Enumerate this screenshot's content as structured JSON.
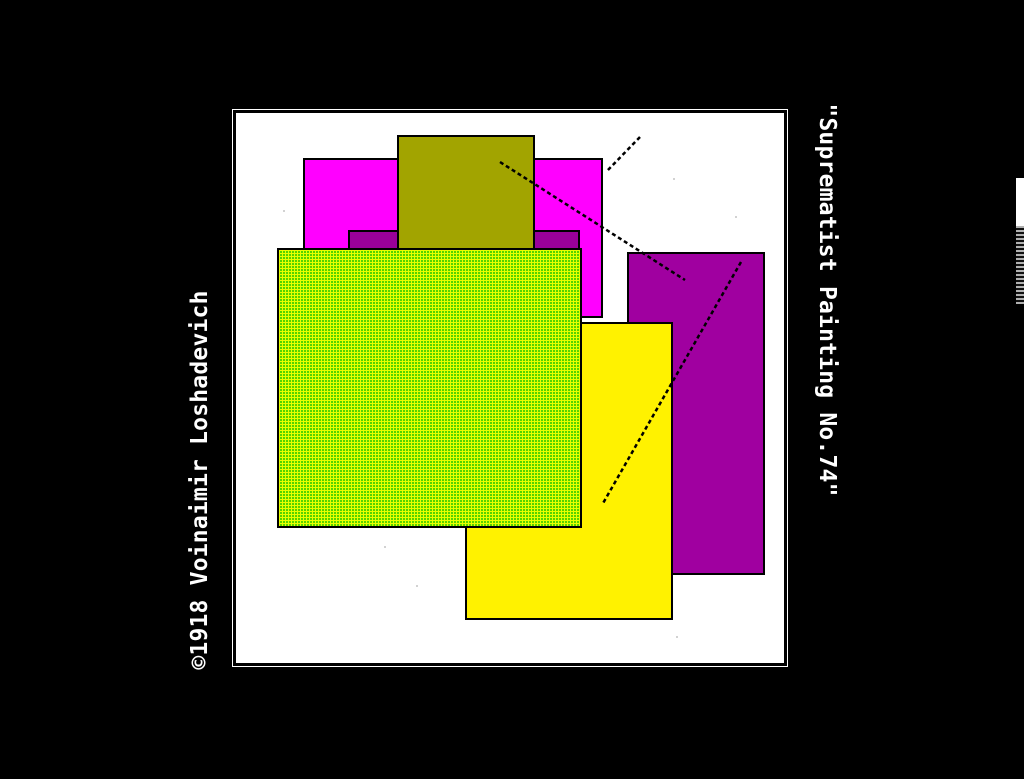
{
  "page": {
    "background": "#000000"
  },
  "artwork": {
    "credit": "©1918 Voinaimir Loshadevich",
    "title": "\"Suprematist Painting No.74\""
  },
  "canvas": {
    "x": 233,
    "y": 110,
    "w": 554,
    "h": 556,
    "color": "#ffffff",
    "border": "#000000"
  },
  "shapes": {
    "magenta": {
      "x": 67,
      "y": 45,
      "w": 300,
      "h": 160,
      "color": "#ff00ff"
    },
    "darkband": {
      "x": 112,
      "y": 117,
      "w": 232,
      "h": 40,
      "color": "#990099"
    },
    "olive": {
      "x": 161,
      "y": 22,
      "w": 138,
      "h": 120,
      "color": "#a2a400"
    },
    "purple": {
      "x": 391,
      "y": 139,
      "w": 138,
      "h": 323,
      "color": "#a000a0"
    },
    "yellow": {
      "x": 229,
      "y": 209,
      "w": 208,
      "h": 298,
      "color": "#fff200"
    },
    "green": {
      "x": 41,
      "y": 135,
      "w": 305,
      "h": 280,
      "color": "#55d400",
      "grid_color": "#e8ff00"
    }
  },
  "lines": {
    "a": {
      "x1": 404,
      "y1": 24,
      "x2": 370,
      "y2": 59
    },
    "b": {
      "x1": 264,
      "y1": 49,
      "x2": 449,
      "y2": 167
    },
    "c": {
      "x1": 505,
      "y1": 149,
      "x2": 366,
      "y2": 392
    }
  },
  "specks": {
    "s1": {
      "x": 47,
      "y": 97,
      "w": 2,
      "h": 2,
      "color": "#c4c4c4"
    },
    "s2": {
      "x": 437,
      "y": 65,
      "w": 2,
      "h": 2,
      "color": "#c4c4c4"
    },
    "s3": {
      "x": 499,
      "y": 103,
      "w": 2,
      "h": 2,
      "color": "#c4c4c4"
    },
    "s4": {
      "x": 148,
      "y": 433,
      "w": 2,
      "h": 2,
      "color": "#c4c4c4"
    },
    "s5": {
      "x": 180,
      "y": 472,
      "w": 2,
      "h": 2,
      "color": "#c4c4c4"
    },
    "s6": {
      "x": 440,
      "y": 523,
      "w": 2,
      "h": 2,
      "color": "#c4c4c4"
    }
  },
  "edge": {
    "white": {
      "x": 1016,
      "y": 178,
      "w": 8,
      "h": 48,
      "color": "#ffffff"
    },
    "stripes": {
      "x": 1016,
      "y": 226,
      "w": 8,
      "h": 78,
      "color": "#808080"
    }
  }
}
